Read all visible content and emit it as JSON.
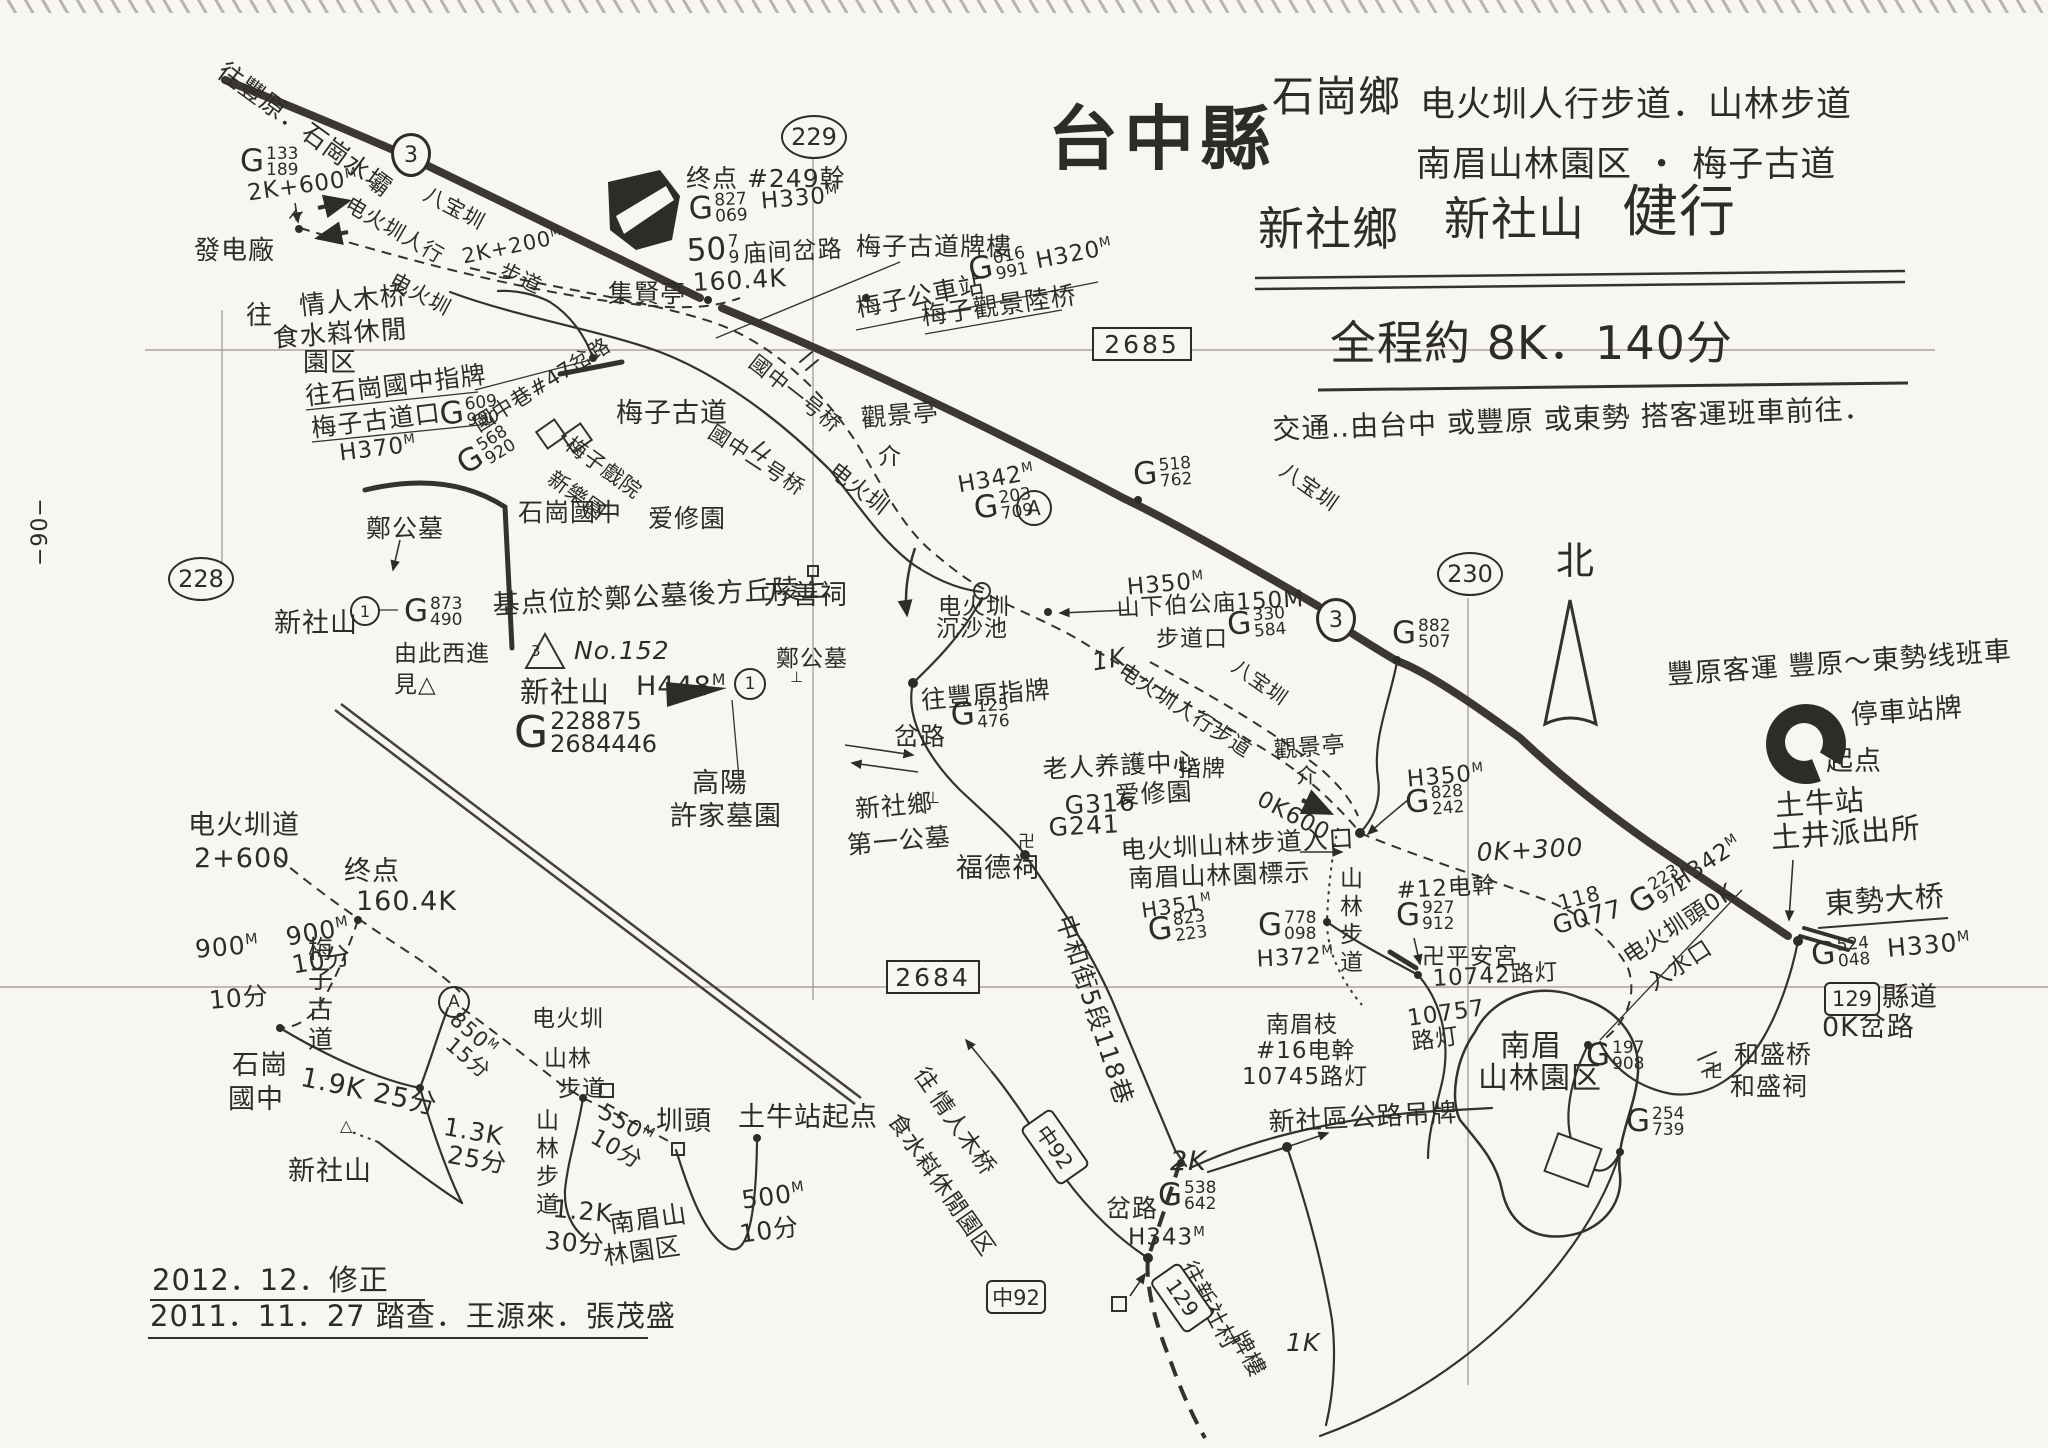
{
  "colors": {
    "ink": "#2e2c29",
    "paper": "#f8f6f1"
  },
  "header": {
    "county": "台中縣",
    "township1": "石崗鄉",
    "township2": "新社鄉",
    "routes1": "电火圳人行步道．山林步道",
    "routes2": "南眉山林園区 ・ 梅子古道",
    "peak": "新社山",
    "activity": "健行",
    "summary": "全程約 8K．140分",
    "transport": "交通‥由台中 或豐原 或東勢 搭客運班車前往．"
  },
  "footer": {
    "revised": "2012．12．修正",
    "surveyed": "2011．11．27 踏查．王源來．張茂盛"
  },
  "page_no": "−90−",
  "labels": [
    {
      "t": "台中縣",
      "x": 1048,
      "y": 104,
      "s": 70,
      "b": 1,
      "n": "map-title"
    },
    {
      "t": "石崗鄉",
      "x": 1272,
      "y": 76,
      "s": 42
    },
    {
      "t": "电火圳人行步道．山林步道",
      "x": 1420,
      "y": 88,
      "s": 35
    },
    {
      "t": "南眉山林園区 ・ 梅子古道",
      "x": 1416,
      "y": 148,
      "s": 35
    },
    {
      "t": "新社鄉",
      "x": 1258,
      "y": 206,
      "s": 46
    },
    {
      "t": "新社山",
      "x": 1444,
      "y": 196,
      "s": 46
    },
    {
      "t": "健行",
      "x": 1622,
      "y": 184,
      "s": 56
    },
    {
      "t": "全程約 8K．140分",
      "x": 1330,
      "y": 320,
      "s": 46,
      "n": "route-summary"
    },
    {
      "t": "交通‥由台中 或豐原 或東勢 搭客運班車前往．",
      "x": 1272,
      "y": 416,
      "s": 28,
      "r": -2,
      "n": "transport-note"
    },
    {
      "t": "往豐原．石崗水壩",
      "x": 228,
      "y": 58,
      "s": 25,
      "r": 36
    },
    {
      "t": "2K+600",
      "m": "M",
      "x": 246,
      "y": 182,
      "s": 23,
      "r": -8
    },
    {
      "t": "發电廠",
      "x": 194,
      "y": 238,
      "s": 26
    },
    {
      "t": "电火圳人行",
      "x": 352,
      "y": 194,
      "s": 21,
      "r": 30
    },
    {
      "t": "八宝圳",
      "x": 430,
      "y": 184,
      "s": 21,
      "r": 28
    },
    {
      "t": "2K+200",
      "m": "M",
      "x": 460,
      "y": 246,
      "s": 21,
      "r": -12
    },
    {
      "t": "步道",
      "x": 505,
      "y": 260,
      "s": 21,
      "r": 25
    },
    {
      "t": "电火圳",
      "x": 396,
      "y": 270,
      "s": 21,
      "r": 28
    },
    {
      "t": "往",
      "x": 246,
      "y": 303,
      "s": 26
    },
    {
      "t": "情人木桥",
      "x": 298,
      "y": 294,
      "s": 26,
      "r": -6
    },
    {
      "t": "食水嵙休閒",
      "x": 272,
      "y": 326,
      "s": 26,
      "r": -4
    },
    {
      "t": "園区",
      "x": 303,
      "y": 350,
      "s": 26
    },
    {
      "t": "往石崗國中指牌",
      "x": 304,
      "y": 384,
      "s": 25,
      "r": -7
    },
    {
      "t": "梅子古道口",
      "x": 310,
      "y": 416,
      "s": 25,
      "r": -7
    },
    {
      "t": "H370",
      "m": "M",
      "x": 338,
      "y": 442,
      "s": 23,
      "r": -7
    },
    {
      "t": "國中巷#47岔路",
      "x": 470,
      "y": 418,
      "s": 21,
      "r": -32
    },
    {
      "t": "集賢亭",
      "x": 608,
      "y": 281,
      "s": 25
    },
    {
      "t": "终点 #249幹",
      "x": 686,
      "y": 166,
      "s": 25
    },
    {
      "t": "H330",
      "m": "M",
      "x": 760,
      "y": 190,
      "s": 23,
      "r": -5
    },
    {
      "t": "庙间岔路",
      "x": 742,
      "y": 242,
      "s": 24,
      "r": -3
    },
    {
      "t": "160.4K",
      "x": 692,
      "y": 270,
      "s": 25,
      "r": -3
    },
    {
      "t": "梅子古道牌樓",
      "x": 856,
      "y": 234,
      "s": 25
    },
    {
      "t": "梅子公車站",
      "x": 854,
      "y": 296,
      "s": 25,
      "r": -11
    },
    {
      "t": "H320",
      "m": "M",
      "x": 1034,
      "y": 250,
      "s": 23,
      "r": -11
    },
    {
      "t": "梅子觀景陸桥",
      "x": 920,
      "y": 304,
      "s": 25,
      "r": -8
    },
    {
      "t": "國中一号桥",
      "x": 758,
      "y": 352,
      "s": 21,
      "r": 38
    },
    {
      "t": "梅子古道",
      "x": 616,
      "y": 400,
      "s": 27
    },
    {
      "t": "國中二号桥",
      "x": 716,
      "y": 422,
      "s": 21,
      "r": 33
    },
    {
      "t": "石崗國中",
      "x": 518,
      "y": 500,
      "s": 25
    },
    {
      "t": "梅子戲院",
      "x": 574,
      "y": 434,
      "s": 21,
      "r": 36
    },
    {
      "t": "新樂園",
      "x": 556,
      "y": 468,
      "s": 21,
      "r": 36
    },
    {
      "t": "爱修園",
      "x": 648,
      "y": 506,
      "s": 25
    },
    {
      "t": "觀景亭",
      "x": 860,
      "y": 406,
      "s": 25,
      "r": -5
    },
    {
      "t": "介",
      "x": 878,
      "y": 446,
      "s": 23
    },
    {
      "t": "H342",
      "m": "M",
      "x": 956,
      "y": 474,
      "s": 23,
      "r": -10
    },
    {
      "t": "八宝圳",
      "x": 1288,
      "y": 460,
      "s": 21,
      "r": 35
    },
    {
      "t": "电火圳",
      "x": 838,
      "y": 460,
      "s": 22,
      "r": 38
    },
    {
      "t": "鄭公墓",
      "x": 366,
      "y": 516,
      "s": 25
    },
    {
      "t": "新社山",
      "x": 274,
      "y": 610,
      "s": 27
    },
    {
      "t": "由此西進",
      "x": 394,
      "y": 643,
      "s": 23
    },
    {
      "t": "見△",
      "x": 394,
      "y": 674,
      "s": 23
    },
    {
      "t": "−90−",
      "x": 30,
      "y": 566,
      "s": 22,
      "r": -90,
      "n": "page-number"
    },
    {
      "t": "基点位於鄭公墓後方丘陵上",
      "x": 492,
      "y": 592,
      "s": 27,
      "r": -3
    },
    {
      "t": "No.152",
      "x": 574,
      "y": 638,
      "s": 25,
      "i": 1
    },
    {
      "t": "新社山",
      "x": 520,
      "y": 678,
      "s": 29
    },
    {
      "t": "H448",
      "m": "M",
      "x": 636,
      "y": 672,
      "s": 27
    },
    {
      "t": "鄭公墓",
      "x": 776,
      "y": 648,
      "s": 23
    },
    {
      "t": "⊥",
      "x": 790,
      "y": 670,
      "s": 15
    },
    {
      "t": "万善祠",
      "x": 764,
      "y": 582,
      "s": 27
    },
    {
      "t": "高陽",
      "x": 692,
      "y": 770,
      "s": 27
    },
    {
      "t": "許家墓園",
      "x": 670,
      "y": 803,
      "s": 27
    },
    {
      "t": "新社鄉",
      "x": 854,
      "y": 797,
      "s": 25,
      "r": -5
    },
    {
      "t": "⊥",
      "x": 926,
      "y": 790,
      "s": 16
    },
    {
      "t": "第一公墓",
      "x": 846,
      "y": 833,
      "s": 25,
      "r": -5
    },
    {
      "t": "福德祠",
      "x": 956,
      "y": 855,
      "s": 27
    },
    {
      "t": "卍",
      "x": 1018,
      "y": 834,
      "s": 17
    },
    {
      "t": "往豐原指牌",
      "x": 920,
      "y": 688,
      "s": 25,
      "r": -5
    },
    {
      "t": "岔路",
      "x": 894,
      "y": 724,
      "s": 25
    },
    {
      "t": "电火圳",
      "x": 938,
      "y": 596,
      "s": 23
    },
    {
      "t": "沉沙池",
      "x": 936,
      "y": 618,
      "s": 23
    },
    {
      "t": "H350",
      "m": "M",
      "x": 1126,
      "y": 576,
      "s": 23,
      "r": -5
    },
    {
      "t": "山下伯公庙150M",
      "x": 1116,
      "y": 598,
      "s": 23,
      "r": -3
    },
    {
      "t": "步道口",
      "x": 1156,
      "y": 628,
      "s": 23
    },
    {
      "t": "1K",
      "x": 1090,
      "y": 650,
      "s": 25,
      "i": 1,
      "r": -10
    },
    {
      "t": "电火圳人行步道",
      "x": 1126,
      "y": 660,
      "s": 21,
      "r": 33
    },
    {
      "t": "八宝圳",
      "x": 1240,
      "y": 656,
      "s": 20,
      "r": 35
    },
    {
      "t": "觀景亭",
      "x": 1273,
      "y": 740,
      "s": 23,
      "r": -5
    },
    {
      "t": "介",
      "x": 1296,
      "y": 766,
      "s": 21
    },
    {
      "t": "指牌",
      "x": 1178,
      "y": 758,
      "s": 23
    },
    {
      "t": "0K600",
      "x": 1264,
      "y": 788,
      "s": 23,
      "r": 28
    },
    {
      "t": "H350",
      "m": "M",
      "x": 1406,
      "y": 768,
      "s": 23,
      "r": -5
    },
    {
      "t": "0K+300",
      "x": 1476,
      "y": 840,
      "s": 25,
      "i": 1,
      "r": -3
    },
    {
      "t": "老人养護中心",
      "x": 1042,
      "y": 757,
      "s": 25,
      "r": -3
    },
    {
      "t": "G316",
      "x": 1064,
      "y": 793,
      "s": 25,
      "r": -3
    },
    {
      "t": "爱修園",
      "x": 1114,
      "y": 783,
      "s": 25,
      "r": -3
    },
    {
      "t": "G241",
      "x": 1048,
      "y": 815,
      "s": 25,
      "r": -3
    },
    {
      "t": "电火圳山林步道入口",
      "x": 1120,
      "y": 838,
      "s": 25,
      "r": -3
    },
    {
      "t": "南眉山林園標示",
      "x": 1128,
      "y": 866,
      "s": 25,
      "r": -2
    },
    {
      "t": "H351",
      "m": "M",
      "x": 1140,
      "y": 900,
      "s": 21,
      "r": -8
    },
    {
      "t": "中和街5段118巷",
      "x": 1076,
      "y": 912,
      "s": 25,
      "r": 72
    },
    {
      "t": "山林步道",
      "x": 1336,
      "y": 866,
      "s": 23,
      "v": 1
    },
    {
      "t": "#12电幹",
      "x": 1396,
      "y": 880,
      "s": 23,
      "r": -3
    },
    {
      "t": "卍平安宮",
      "x": 1422,
      "y": 946,
      "s": 23
    },
    {
      "t": "10742路灯",
      "x": 1432,
      "y": 968,
      "s": 23,
      "r": -3
    },
    {
      "t": "H372",
      "m": "M",
      "x": 1256,
      "y": 948,
      "s": 23,
      "r": -3
    },
    {
      "t": "10757",
      "x": 1406,
      "y": 1008,
      "s": 23,
      "r": -8
    },
    {
      "t": "路灯",
      "x": 1410,
      "y": 1032,
      "s": 23,
      "r": -8
    },
    {
      "t": "南眉枝",
      "x": 1266,
      "y": 1014,
      "s": 23
    },
    {
      "t": "#16电幹",
      "x": 1256,
      "y": 1040,
      "s": 23
    },
    {
      "t": "10745路灯",
      "x": 1242,
      "y": 1066,
      "s": 23
    },
    {
      "t": "南眉",
      "x": 1500,
      "y": 1032,
      "s": 30
    },
    {
      "t": "山林園区",
      "x": 1478,
      "y": 1064,
      "s": 30
    },
    {
      "t": "新社區公路吊牌",
      "x": 1268,
      "y": 1110,
      "s": 26,
      "r": -3
    },
    {
      "t": "2K",
      "x": 1170,
      "y": 1148,
      "s": 27,
      "i": 1
    },
    {
      "t": "岔路",
      "x": 1106,
      "y": 1196,
      "s": 25
    },
    {
      "t": "H343",
      "m": "M",
      "x": 1128,
      "y": 1226,
      "s": 23
    },
    {
      "t": "往",
      "x": 928,
      "y": 1064,
      "s": 23,
      "r": 55
    },
    {
      "t": "情人木桥",
      "x": 944,
      "y": 1088,
      "s": 23,
      "r": 55
    },
    {
      "t": "食水嵙休閒園区",
      "x": 902,
      "y": 1110,
      "s": 23,
      "r": 55
    },
    {
      "t": "1K",
      "x": 1286,
      "y": 1330,
      "s": 25,
      "i": 1
    },
    {
      "t": "往新社村",
      "x": 1196,
      "y": 1258,
      "s": 23,
      "r": 62
    },
    {
      "t": "牌樓",
      "x": 1246,
      "y": 1328,
      "s": 23,
      "r": 62
    },
    {
      "t": "电火圳道",
      "x": 188,
      "y": 812,
      "s": 27
    },
    {
      "t": "2+600",
      "x": 194,
      "y": 845,
      "s": 27
    },
    {
      "t": "终点",
      "x": 344,
      "y": 858,
      "s": 27
    },
    {
      "t": "160.4K",
      "x": 356,
      "y": 888,
      "s": 27
    },
    {
      "t": "900",
      "m": "M",
      "x": 194,
      "y": 937,
      "s": 25,
      "r": -5
    },
    {
      "t": "10分",
      "x": 208,
      "y": 988,
      "s": 25,
      "r": -5
    },
    {
      "t": "900",
      "m": "M",
      "x": 284,
      "y": 925,
      "s": 25,
      "r": -10
    },
    {
      "t": "10分",
      "x": 290,
      "y": 953,
      "s": 25,
      "r": -10
    },
    {
      "t": "梅子古道",
      "x": 306,
      "y": 936,
      "s": 25,
      "v": 1
    },
    {
      "t": "石崗",
      "x": 232,
      "y": 1052,
      "s": 27
    },
    {
      "t": "國中",
      "x": 228,
      "y": 1086,
      "s": 27
    },
    {
      "t": "1.9K 25分",
      "x": 304,
      "y": 1064,
      "s": 27,
      "r": 12
    },
    {
      "t": "1.3K",
      "x": 446,
      "y": 1114,
      "s": 25,
      "r": 10
    },
    {
      "t": "25分",
      "x": 450,
      "y": 1142,
      "s": 25,
      "r": 10
    },
    {
      "t": "新社山",
      "x": 288,
      "y": 1158,
      "s": 27
    },
    {
      "t": "△",
      "x": 340,
      "y": 1118,
      "s": 16
    },
    {
      "t": "850",
      "m": "M",
      "x": 460,
      "y": 1008,
      "s": 21,
      "r": 40
    },
    {
      "t": "15分",
      "x": 455,
      "y": 1034,
      "s": 21,
      "r": 40
    },
    {
      "t": "电火圳",
      "x": 532,
      "y": 1008,
      "s": 23
    },
    {
      "t": "山林",
      "x": 544,
      "y": 1048,
      "s": 23
    },
    {
      "t": "步道",
      "x": 558,
      "y": 1078,
      "s": 23
    },
    {
      "t": "山林步道",
      "x": 532,
      "y": 1108,
      "s": 23,
      "v": 1
    },
    {
      "t": "550",
      "m": "M",
      "x": 606,
      "y": 1100,
      "s": 23,
      "r": 30
    },
    {
      "t": "10分",
      "x": 598,
      "y": 1126,
      "s": 23,
      "r": 30
    },
    {
      "t": "圳頭",
      "x": 656,
      "y": 1108,
      "s": 27
    },
    {
      "t": "土牛站起点",
      "x": 738,
      "y": 1104,
      "s": 27
    },
    {
      "t": "500",
      "m": "M",
      "x": 740,
      "y": 1188,
      "s": 25,
      "r": -8
    },
    {
      "t": "10分",
      "x": 738,
      "y": 1222,
      "s": 25,
      "r": -8
    },
    {
      "t": "1.2K",
      "x": 554,
      "y": 1196,
      "s": 25,
      "r": 5
    },
    {
      "t": "30分",
      "x": 546,
      "y": 1228,
      "s": 25,
      "r": 5
    },
    {
      "t": "南眉山",
      "x": 608,
      "y": 1212,
      "s": 25,
      "r": -8
    },
    {
      "t": "林園区",
      "x": 602,
      "y": 1244,
      "s": 25,
      "r": -8
    },
    {
      "t": "2012．12．修正",
      "x": 152,
      "y": 1266,
      "s": 29,
      "n": "revision-date"
    },
    {
      "t": "2011．11．27 踏查．王源來．張茂盛",
      "x": 150,
      "y": 1302,
      "s": 29,
      "n": "survey-credit"
    },
    {
      "t": "豐原客運 豐原～東勢线班車",
      "x": 1666,
      "y": 662,
      "s": 27,
      "r": -4
    },
    {
      "t": "停車站牌",
      "x": 1850,
      "y": 702,
      "s": 27,
      "r": -4
    },
    {
      "t": "起点",
      "x": 1826,
      "y": 748,
      "s": 27
    },
    {
      "t": "土牛站",
      "x": 1774,
      "y": 792,
      "s": 29,
      "r": -4
    },
    {
      "t": "土井派出所",
      "x": 1770,
      "y": 824,
      "s": 29,
      "r": -4
    },
    {
      "t": "東勢大桥",
      "x": 1824,
      "y": 890,
      "s": 29,
      "r": -4
    },
    {
      "t": "H330",
      "m": "M",
      "x": 1886,
      "y": 936,
      "s": 25,
      "r": -5
    },
    {
      "t": "縣道",
      "x": 1882,
      "y": 984,
      "s": 27
    },
    {
      "t": "0K岔路",
      "x": 1822,
      "y": 1014,
      "s": 27
    },
    {
      "t": "H342",
      "m": "M",
      "x": 1668,
      "y": 874,
      "s": 23,
      "r": -33
    },
    {
      "t": "电火圳頭0K",
      "x": 1620,
      "y": 950,
      "s": 23,
      "r": -33
    },
    {
      "t": "入水口",
      "x": 1644,
      "y": 976,
      "s": 23,
      "r": -33
    },
    {
      "t": "118",
      "x": 1556,
      "y": 894,
      "s": 21,
      "r": -15
    },
    {
      "t": "G077",
      "x": 1550,
      "y": 914,
      "s": 25,
      "r": -15
    },
    {
      "t": "和盛桥",
      "x": 1734,
      "y": 1042,
      "s": 25
    },
    {
      "t": "和盛祠",
      "x": 1730,
      "y": 1074,
      "s": 25
    },
    {
      "t": "卍",
      "x": 1704,
      "y": 1062,
      "s": 19
    },
    {
      "t": "北",
      "x": 1556,
      "y": 542,
      "s": 38,
      "n": "north-label"
    },
    {
      "t": "3",
      "x": 531,
      "y": 644,
      "s": 15
    }
  ],
  "gnums": [
    {
      "p": "G",
      "top": "133",
      "bot": "189",
      "x": 240,
      "y": 146
    },
    {
      "p": "G",
      "top": "827",
      "bot": "069",
      "x": 688,
      "y": 194,
      "r": -3
    },
    {
      "p": "50",
      "top": "7",
      "bot": "9",
      "x": 686,
      "y": 236,
      "r": -3
    },
    {
      "p": "G",
      "top": "016",
      "bot": "991",
      "x": 966,
      "y": 256,
      "r": -11
    },
    {
      "p": "G",
      "top": "609",
      "bot": "990",
      "x": 438,
      "y": 400,
      "r": -7
    },
    {
      "p": "G",
      "top": "568",
      "bot": "920",
      "x": 452,
      "y": 454,
      "r": -32
    },
    {
      "p": "G",
      "top": "873",
      "bot": "490",
      "x": 404,
      "y": 596
    },
    {
      "p": "G",
      "top": "228875",
      "bot": "2684446",
      "x": 514,
      "y": 710,
      "big": 1
    },
    {
      "p": "G",
      "top": "203",
      "bot": "709",
      "x": 972,
      "y": 494,
      "r": -8
    },
    {
      "p": "G",
      "top": "518",
      "bot": "762",
      "x": 1132,
      "y": 460,
      "r": -5
    },
    {
      "p": "G",
      "top": "125",
      "bot": "476",
      "x": 950,
      "y": 700,
      "r": -3
    },
    {
      "p": "G",
      "top": "330",
      "bot": "584",
      "x": 1226,
      "y": 610,
      "r": -5
    },
    {
      "p": "G",
      "top": "828",
      "bot": "242",
      "x": 1404,
      "y": 788,
      "r": -5
    },
    {
      "p": "G",
      "top": "823",
      "bot": "223",
      "x": 1146,
      "y": 916,
      "r": -8
    },
    {
      "p": "G",
      "top": "927",
      "bot": "912",
      "x": 1396,
      "y": 900
    },
    {
      "p": "G",
      "top": "778",
      "bot": "098",
      "x": 1258,
      "y": 910
    },
    {
      "p": "G",
      "top": "538",
      "bot": "642",
      "x": 1158,
      "y": 1180
    },
    {
      "p": "G",
      "top": "882",
      "bot": "507",
      "x": 1392,
      "y": 618
    },
    {
      "p": "G",
      "top": "524",
      "bot": "048",
      "x": 1810,
      "y": 940,
      "r": -5
    },
    {
      "p": "G",
      "top": "223",
      "bot": "972",
      "x": 1624,
      "y": 894,
      "r": -33
    },
    {
      "p": "G",
      "top": "197",
      "bot": "908",
      "x": 1586,
      "y": 1040
    },
    {
      "p": "G",
      "top": "254",
      "bot": "739",
      "x": 1626,
      "y": 1106
    }
  ],
  "shields": [
    {
      "t": "3",
      "x": 391,
      "y": 133
    },
    {
      "t": "3",
      "x": 1316,
      "y": 598
    }
  ],
  "grid_refs": [
    {
      "t": "229",
      "x": 781,
      "y": 115
    },
    {
      "t": "228",
      "x": 168,
      "y": 557
    },
    {
      "t": "230",
      "x": 1437,
      "y": 552
    }
  ],
  "grid_boxes": [
    {
      "t": "2685",
      "x": 1092,
      "y": 327,
      "w": 96,
      "h": 30
    },
    {
      "t": "2684",
      "x": 886,
      "y": 960,
      "w": 90,
      "h": 30
    }
  ],
  "road_boxes": [
    {
      "t": "中92",
      "x": 1020,
      "y": 1128,
      "w": 66,
      "h": 34,
      "r": 55
    },
    {
      "t": "129",
      "x": 1150,
      "y": 1280,
      "w": 60,
      "h": 32,
      "r": 55
    },
    {
      "t": "129",
      "x": 1824,
      "y": 982,
      "w": 52,
      "h": 30,
      "r": 0
    },
    {
      "t": "中92",
      "x": 986,
      "y": 1280,
      "w": 56,
      "h": 30,
      "r": 0
    }
  ],
  "circle_marks": [
    {
      "t": "1",
      "x": 350,
      "y": 596,
      "d": 26
    },
    {
      "t": "1",
      "x": 734,
      "y": 668,
      "d": 28
    },
    {
      "t": "A",
      "x": 1016,
      "y": 490,
      "d": 32
    },
    {
      "t": "A",
      "x": 438,
      "y": 986,
      "d": 28
    }
  ],
  "icons": [
    "north-arrow-icon",
    "start-point-fan-icon",
    "summit-pennant-icon",
    "terminus-block-icon",
    "temple-swastika-icon",
    "triangulation-triangle-icon",
    "silt-pond-circle-icon"
  ]
}
